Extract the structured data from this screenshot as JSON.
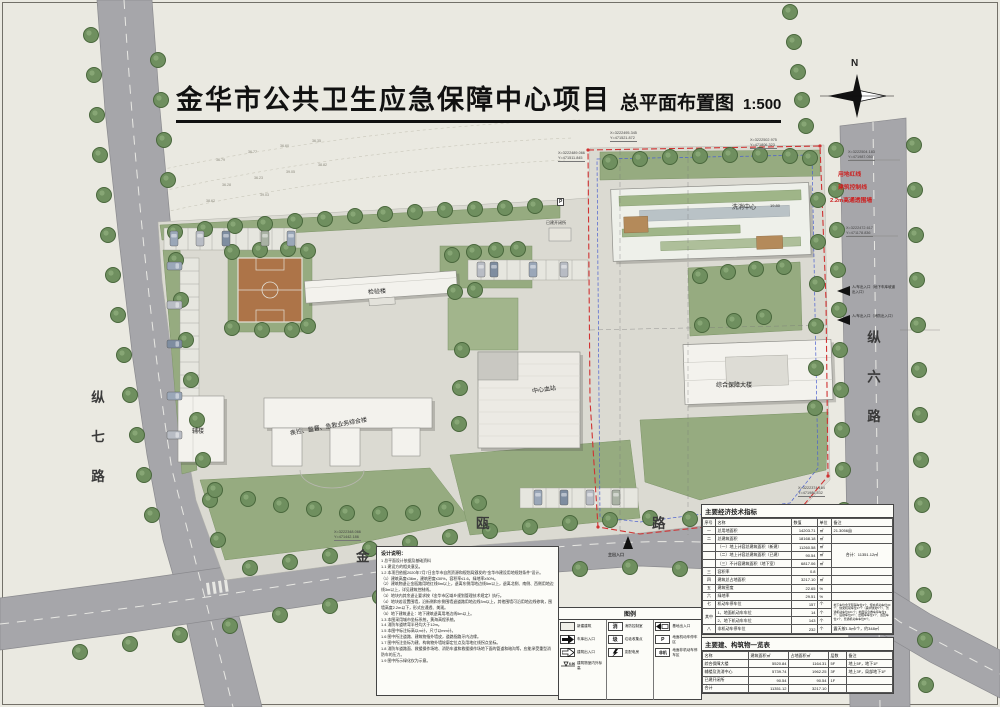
{
  "title": {
    "main": "金华市公共卫生应急保障中心项目",
    "sub": "总平面布置图",
    "scale": "1:500"
  },
  "compass": {
    "label": "N"
  },
  "roads": {
    "west": "纵七路",
    "east": "纵六路",
    "south_chars": [
      "金",
      "瓯",
      "路"
    ]
  },
  "map_labels": {
    "lab_building": "检验楼",
    "aux_building": "辅楼",
    "cdc_building": "疾控、监督、急救业务综合楼",
    "blood_center": "中心血站",
    "support_tower": "综合保障大楼",
    "decon_center": "洗消中心",
    "decon_elev": "19.80",
    "existing": "已建开闭所",
    "parking_sign": "P"
  },
  "red_notes": [
    "用地红线",
    "建筑控制线",
    "2.2m高通透围墙"
  ],
  "entries": {
    "south": "主出入口",
    "right_top": "人/车出入口（地下车库坡道出入口）",
    "right_bottom": "人/车出入口（消防出入口）"
  },
  "coordinates": [
    {
      "x": "X=3222489.066",
      "y": "Y=471511.845"
    },
    {
      "x": "X=3222495.345",
      "y": "Y=471521.872"
    },
    {
      "x": "X=3222502.975",
      "y": "Y=471806.323"
    },
    {
      "x": "X=3222504.183",
      "y": "Y=471987.050"
    },
    {
      "x": "X=3222472.617",
      "y": "Y=471178.836"
    },
    {
      "x": "X=3222374.164",
      "y": "Y=471986.532"
    },
    {
      "x": "X=3222348.066",
      "y": "Y=471442.186"
    }
  ],
  "spot_elevations": [
    "36.79",
    "36.77",
    "36.60",
    "36.35",
    "36.28",
    "36.23",
    "39.05",
    "38.82",
    "38.62",
    "39.03"
  ],
  "indicators": {
    "title": "主要经济技术指标",
    "headers": [
      "序号",
      "名称",
      "数值",
      "单位",
      "备注"
    ],
    "rows": [
      {
        "no": "一",
        "name": "总用地面积",
        "value": "14203.71",
        "unit": "㎡",
        "remark": "21.3056亩"
      },
      {
        "no": "二",
        "name": "总建筑面积",
        "value": "18168.18",
        "unit": "㎡",
        "remark": ""
      },
      {
        "no": "",
        "name": "（一）地上计容总建筑面积（新建）",
        "value": "11260.58",
        "unit": "㎡",
        "remark": "合计：11351.12㎡"
      },
      {
        "no": "",
        "name": "（二）地上计容总建筑面积（已建）",
        "value": "90.54",
        "unit": "㎡",
        "remark": ""
      },
      {
        "no": "",
        "name": "（三）不计容建筑面积（地下室）",
        "value": "6817.06",
        "unit": "㎡",
        "remark": ""
      },
      {
        "no": "三",
        "name": "容积率",
        "value": "0.8",
        "unit": "",
        "remark": ""
      },
      {
        "no": "四",
        "name": "建筑总占地面积",
        "value": "3217.10",
        "unit": "㎡",
        "remark": ""
      },
      {
        "no": "五",
        "name": "建筑密度",
        "value": "22.65",
        "unit": "%",
        "remark": ""
      },
      {
        "no": "六",
        "name": "绿地率",
        "value": "29.51",
        "unit": "%",
        "remark": ""
      },
      {
        "no": "七",
        "name": "机动车停车位",
        "value": "157",
        "unit": "个",
        "remark": "地下车位含无障碍车位3个、慢充机动车位30个、快充机动车位17个（其中快充5个）、普通机动车位101个；地面设急救车停车位3个、后勤车位3个、出租车车位1个、巡回车位1个、普通机动车车位8个。"
      },
      {
        "no": "其中",
        "name": "1、地面机动车车位",
        "value": "14",
        "unit": "个",
        "remark": ""
      },
      {
        "no": "",
        "name": "2、地下机动车车位",
        "value": "143",
        "unit": "个",
        "remark": ""
      },
      {
        "no": "八",
        "name": "非机动车停车位",
        "value": "232",
        "unit": "个",
        "remark": "露天按1.5㎡/个，约348㎡"
      }
    ]
  },
  "buildings_table": {
    "title": "主要建、构筑物一览表",
    "headers": [
      "名称",
      "建筑面积㎡",
      "占地面积㎡",
      "层数",
      "备注"
    ],
    "rows": [
      {
        "name": "综合保障大楼",
        "area": "5520.84",
        "footprint": "1164.31",
        "floors": "5F",
        "remark": "地上5F，地下1F"
      },
      {
        "name": "辅楼及洗消中心",
        "area": "5739.74",
        "footprint": "1962.25",
        "floors": "3F",
        "remark": "地上3F，局部地下1F"
      },
      {
        "name": "已建开闭所",
        "area": "90.54",
        "footprint": "90.54",
        "floors": "1F",
        "remark": ""
      },
      {
        "name": "合计",
        "area": "11351.12",
        "footprint": "3217.10",
        "floors": "",
        "remark": ""
      }
    ]
  },
  "legend": {
    "title": "图例",
    "items": [
      {
        "icon": "new-building",
        "label": "新建建筑"
      },
      {
        "icon": "garage-entrance",
        "label": "车库出入口"
      },
      {
        "icon": "building-entrance",
        "label": "建筑出入口"
      },
      {
        "icon": "elevation",
        "label": "建筑物室内外标高"
      },
      {
        "icon": "fire-control",
        "label": "消防控制室"
      },
      {
        "icon": "garbage",
        "label": "垃圾收集点"
      },
      {
        "icon": "power",
        "label": "变配电房"
      },
      {
        "icon": "site-entrance",
        "label": "基地出入口"
      },
      {
        "icon": "parking",
        "label": "地面机动车停车区"
      },
      {
        "icon": "non-motor-parking",
        "label": "地面非机动车停车区"
      }
    ]
  },
  "design_notes": {
    "title": "设计说明：",
    "lines": [
      "1 总平面设计依据及基础资料",
      "1.1 建设方的相关意见。",
      "1.2 本项目依据2020年7月7日金华市自然资源和规划局颁发的“金华市建设用地规划条件”设计。",
      "（1）建筑高度≤36m，建筑密度≤30%，容积率≤1.6，绿地率≥30%。",
      "（2）建筑物退让金瓯路用地红线5m以上，退离东侧用地边线5m以上，退离北侧、南侧、西侧用地边线3m以上，详见建筑控制线。",
      "（3）地块内其余退让要求按《金华市区域乡规划管理技术规定》执行。",
      "（4）地块若设置围墙，沿街侧和东侧围墙退道路用地边线3m以上，其他围墙可沿用地边线修筑，围墙高度2.2m以下，形式应通透、美观。",
      "（5）地下建筑退让：地下建筑退离用地边线5m以上。",
      "1.3 本图采用城市坐标系统，黄海高程系统。",
      "1.4 消防车道转弯半径均大于12m。",
      "1.5 本图中标注标高以m计，尺寸以mm计。",
      "1.6 图中所注道路、建筑物指外墙皮，道路指路牙内边缘。",
      "1.7 图中所注坐标为建、构筑物外墙轮廓定位点及用地红线拐点坐标。",
      "1.8 消防车道路面、救援操作场地、消防车道和救援操作场地下面的管道和暗沟等，应能承受重型消防车的压力。",
      "1.9 图中所示绿化仅为示意。"
    ]
  }
}
